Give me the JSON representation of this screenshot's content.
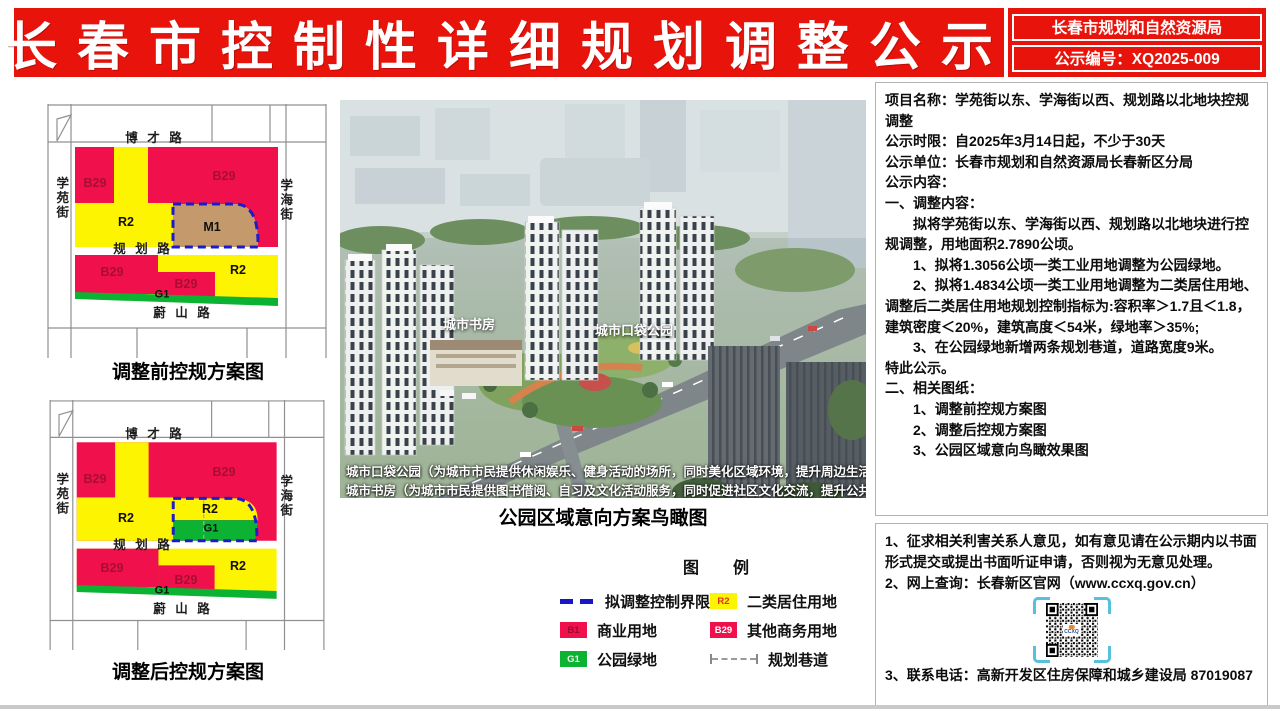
{
  "header": {
    "title": "长春市控制性详细规划调整公示",
    "agency": "长春市规划和自然资源局",
    "notice_number": "公示编号：XQ2025-009"
  },
  "maps": {
    "before_caption": "调整前控规方案图",
    "after_caption": "调整后控规方案图",
    "roads": {
      "top": "博 才 路",
      "left": "学苑街",
      "right": "学海街",
      "middle": "规 划 路",
      "bottom": "蔚 山 路"
    },
    "codes": {
      "b29": "B29",
      "r2": "R2",
      "m1": "M1",
      "g1": "G1"
    }
  },
  "render": {
    "label_library": "城市书房",
    "label_park": "城市口袋公园",
    "note_line1": "城市口袋公园（为城市市民提供休闲娱乐、健身活动的场所，同时美化区域环境，提升周边生活品质）",
    "note_line2": "城市书房（为城市市民提供图书借阅、自习及文化活动服务，同时促进社区文化交流，提升公共文化服务水平）",
    "caption": "公园区域意向方案鸟瞰图"
  },
  "legend": {
    "title_left": "图",
    "title_right": "例",
    "items": [
      {
        "label": "拟调整控制界限"
      },
      {
        "code": "B1",
        "label": "商业用地"
      },
      {
        "code": "G1",
        "label": "公园绿地"
      },
      {
        "code": "R2",
        "label": "二类居住用地"
      },
      {
        "code": "B29",
        "label": "其他商务用地"
      },
      {
        "label": "规划巷道"
      }
    ]
  },
  "notice_panel": {
    "lines": [
      {
        "text": "项目名称：学苑街以东、学海街以西、规划路以北地块控规调整"
      },
      {
        "text": "公示时限：自2025年3月14日起，不少于30天"
      },
      {
        "text": "公示单位：长春市规划和自然资源局长春新区分局"
      },
      {
        "text": "公示内容："
      },
      {
        "text": "一、调整内容："
      },
      {
        "text": "拟将学苑街以东、学海街以西、规划路以北地块进行控规调整，用地面积2.7890公顷。"
      },
      {
        "text": "1、拟将1.3056公顷一类工业用地调整为公园绿地。"
      },
      {
        "text": "2、拟将1.4834公顷一类工业用地调整为二类居住用地、调整后二类居住用地规划控制指标为:容积率＞1.7且＜1.8，建筑密度＜20%，建筑高度＜54米，绿地率＞35%;"
      },
      {
        "text": "3、在公园绿地新增两条规划巷道，道路宽度9米。"
      },
      {
        "text": "特此公示。"
      },
      {
        "text": "二、相关图纸："
      },
      {
        "text": "1、调整前控规方案图"
      },
      {
        "text": "2、调整后控规方案图"
      },
      {
        "text": "3、公园区域意向鸟瞰效果图"
      }
    ]
  },
  "info_panel": {
    "line1": "1、征求相关利害关系人意见，如有意见请在公示期内以书面形式提交或提出书面听证申请，否则视为无意见处理。",
    "line2": "2、网上查询：长春新区官网（www.ccxq.gov.cn）",
    "line3": "3、联系电话：高新开发区住房保障和城乡建设局  87019087",
    "qr_logo": "CCXQ"
  },
  "colors": {
    "banner_red": "#e8140c",
    "zone_commercial_red": "#f0104c",
    "zone_residential_yellow": "#fdf402",
    "zone_park_green": "#0cb232",
    "zone_industrial_tan": "#c49a6d",
    "adjust_boundary_blue": "#1b1bcc",
    "qr_bracket_blue": "#57c0dc"
  }
}
